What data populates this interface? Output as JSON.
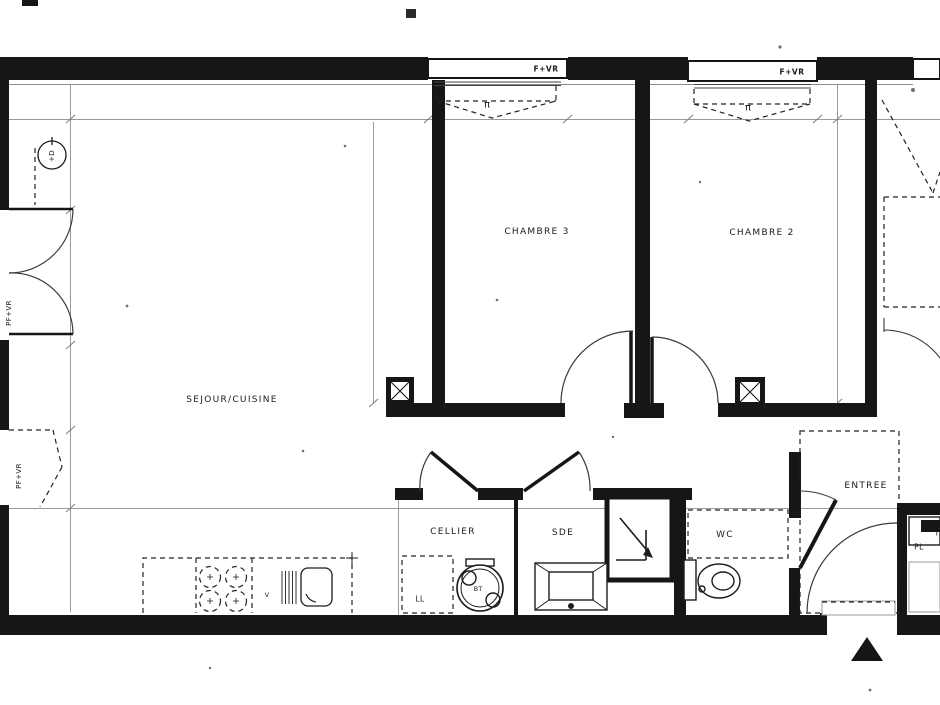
{
  "plan": {
    "title": "apartment-floor-plan",
    "rooms": {
      "sejour": "SEJOUR/CUISINE",
      "chambre3": "CHAMBRE 3",
      "chambre2": "CHAMBRE 2",
      "cellier": "CELLIER",
      "sde": "SDE",
      "wc": "WC",
      "entree": "ENTREE"
    },
    "openings": {
      "window_label": "F+VR",
      "french_door_label": "PF+VR",
      "opening_symbol": "π"
    },
    "fixtures": {
      "washing_machine": "LL",
      "water_heater": "BT",
      "kitchen_sink": "V",
      "closet": "PL",
      "tech_partial": "T",
      "tap_symbol": "+D"
    },
    "colors": {
      "wall": "#161616",
      "thin_line": "#9a9a9a",
      "dash_line": "#222222",
      "background": "#ffffff"
    }
  }
}
